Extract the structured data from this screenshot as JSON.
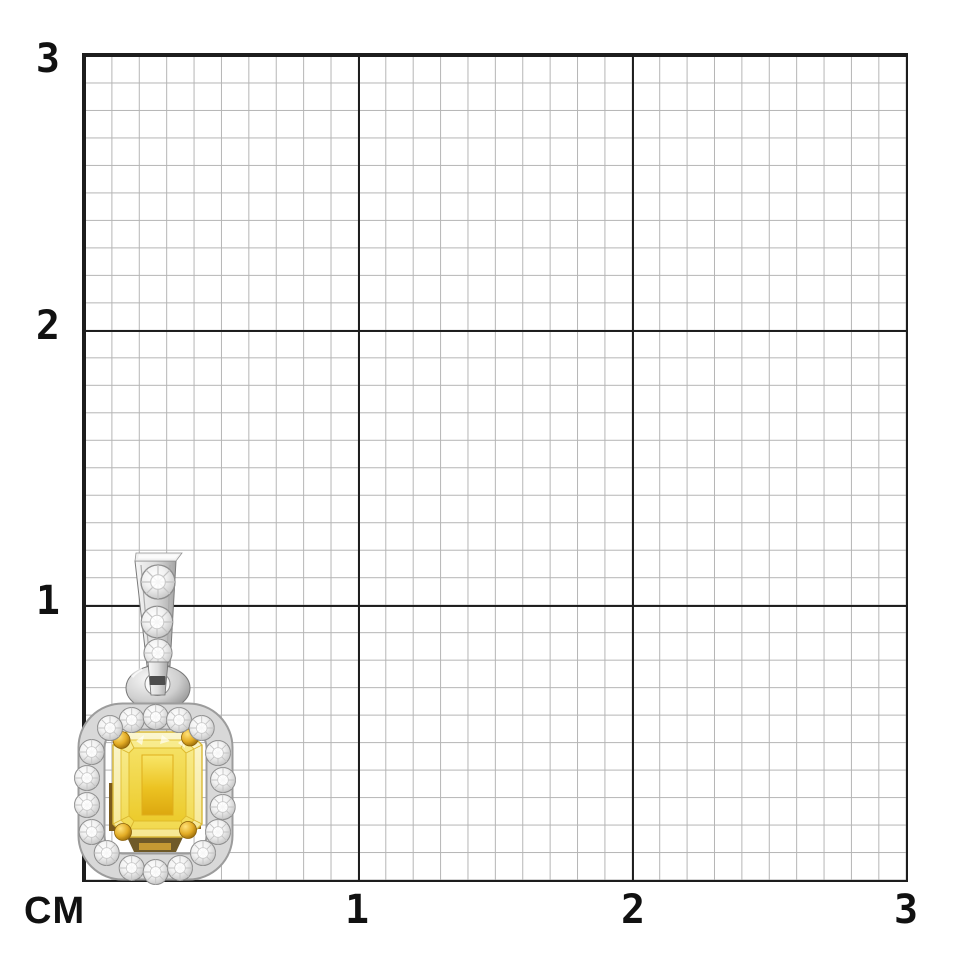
{
  "scene": {
    "description": "Fancy yellow emerald-cut diamond halo pendant photographed on a centimeter measurement grid",
    "background_color": "#ffffff"
  },
  "ruler": {
    "unit_label": "CM",
    "y_axis_labels": [
      "3",
      "2",
      "1"
    ],
    "x_axis_labels": [
      "1",
      "2",
      "3"
    ],
    "minor_cells_per_cm": 10,
    "grid_minor_color": "#b5b5b5",
    "grid_major_color": "#1d1d1d",
    "label_color": "#111111"
  },
  "pendant": {
    "parts": {
      "bail": "diamond-set tapered bail",
      "jump_ring": "white gold jump ring",
      "halo": "round diamond halo",
      "center_stone": "fancy yellow emerald-cut diamond",
      "prongs": "yellow gold corner prongs"
    },
    "colors": {
      "metal": "#d6d6d6",
      "diamond": "#f0f0f0",
      "stone_yellow": "#eec424",
      "stone_yellow_light": "#faf6cf",
      "gold": "#e0a81f"
    },
    "bail_stone_count": 3,
    "halo_stone_count": 18
  }
}
